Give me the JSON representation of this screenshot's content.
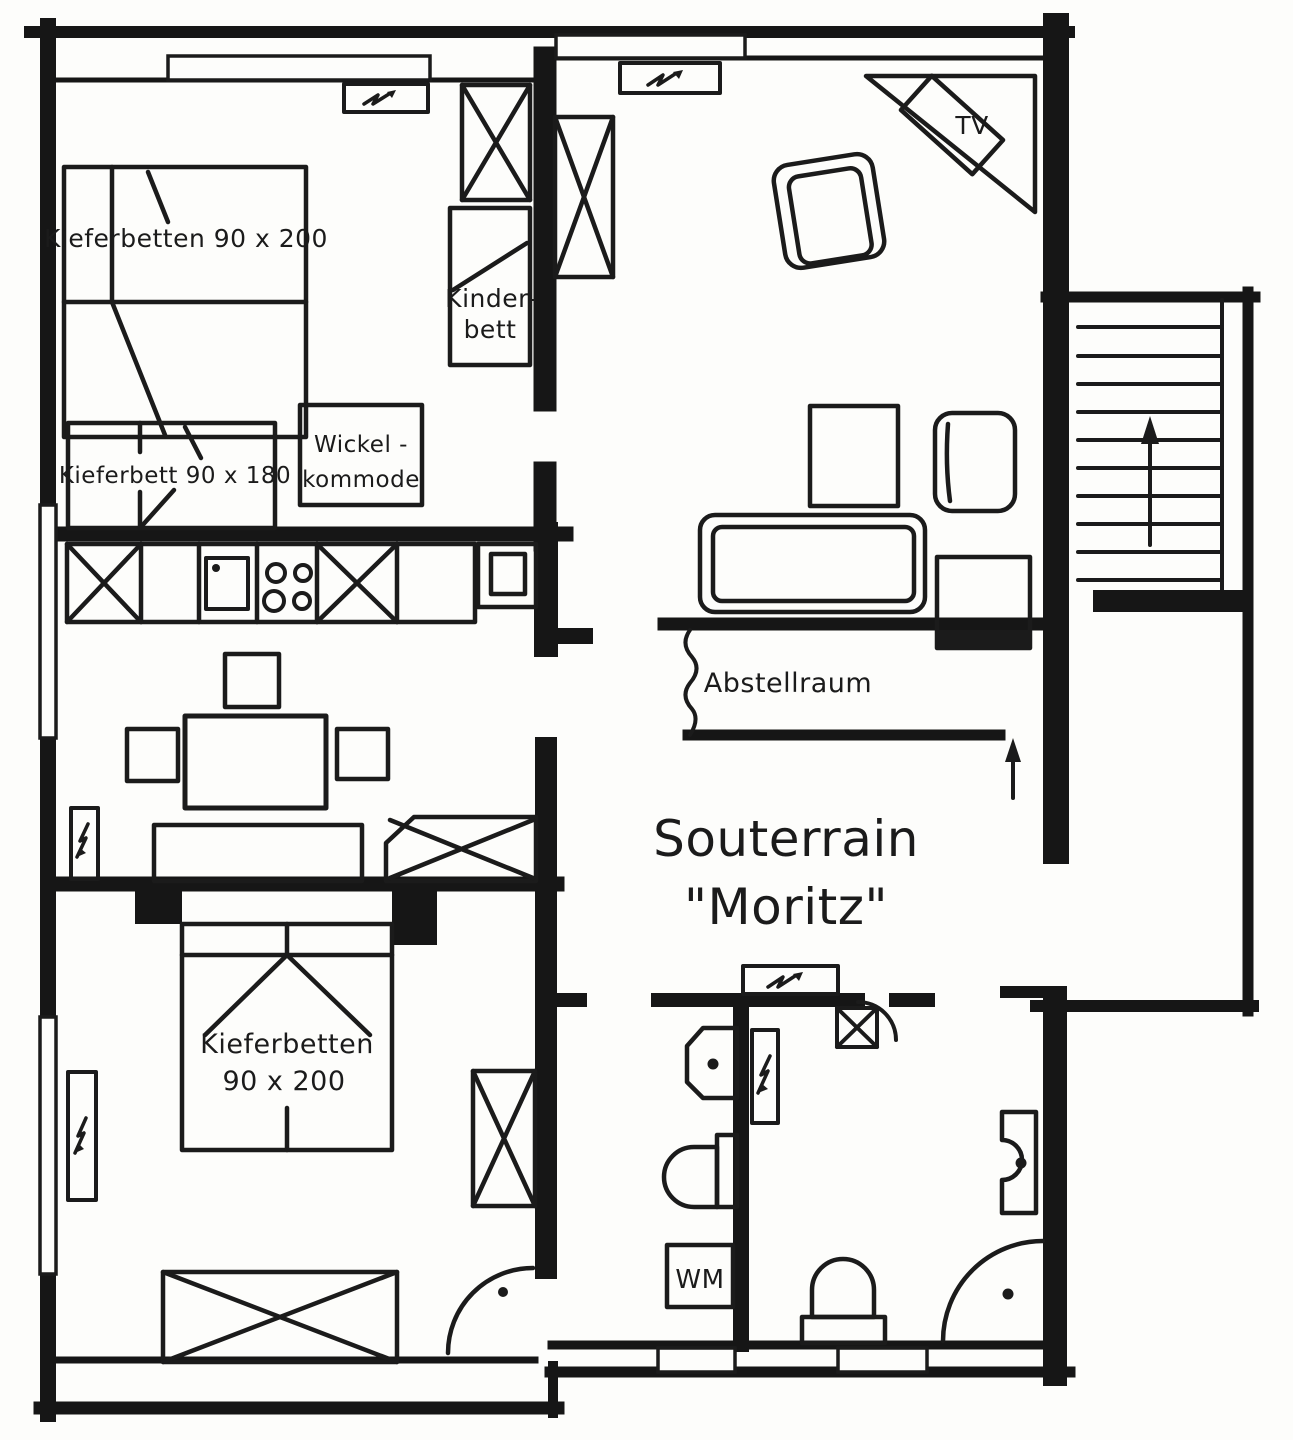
{
  "title": {
    "line1": "Souterrain",
    "line2": "\"Moritz\""
  },
  "rooms": {
    "bedroom_top": {
      "double_bed_label": "Kieferbetten 90 x 200",
      "crib_line1": "Kinder-",
      "crib_line2": "bett",
      "single_bed_label": "Kieferbett 90 x 180",
      "changing_table_line1": "Wickel -",
      "changing_table_line2": "kommode"
    },
    "living": {
      "tv_label": "TV"
    },
    "storage": {
      "label": "Abstellraum"
    },
    "bedroom_bottom": {
      "bed_line1": "Kieferbetten",
      "bed_line2": "90 x 200"
    },
    "bathroom": {
      "washing_machine_label": "WM"
    }
  },
  "colors": {
    "ink": "#1b1b1b",
    "paper": "#fdfdfb"
  }
}
